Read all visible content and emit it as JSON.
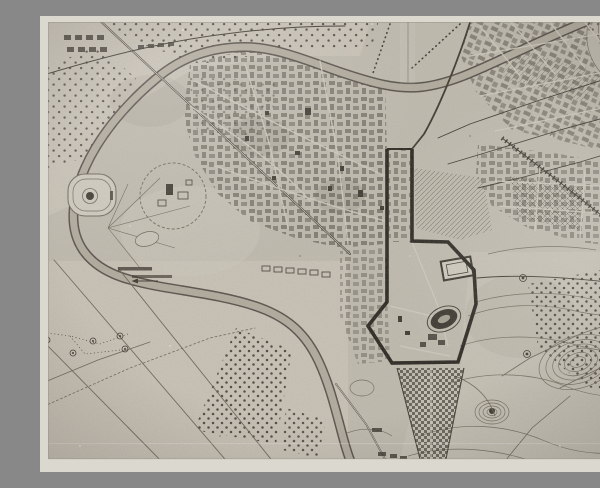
{
  "meta": {
    "title": "Black-and-white photographic print of a vintage surveyed city plan",
    "description": "Aged photo of an engraved town map: a river meanders around the old town in a large bend, a heavy dark boundary line encloses the central monumental zone with an oval amphitheatre ruin, dense hatched city blocks fill the north-east, dotted orchard parcels and contoured hills lie to the south, and a checkered ribbon suburb runs off the bottom edge.",
    "domain": "Map",
    "visible_text": ""
  },
  "theme": {
    "border": "#dbd8cf",
    "border-edge": "#948f83",
    "paper": "#c0bbae",
    "paper-light": "#cfcbbe",
    "ink-dark": "#3e3a31",
    "ink-mid": "#6e6859",
    "bold": "#2a2620",
    "water": "#b3ac9e",
    "bank": "#56514a"
  },
  "photo": {
    "border_widths": {
      "top": 6,
      "right": 11,
      "bottom": 13,
      "left": 8
    },
    "artifacts": [
      "film grain",
      "dust specks",
      "horizontal scratch line",
      "uneven exposure vignette"
    ]
  },
  "map_features": {
    "river": "wide meandering river with double embankment lines",
    "old_town": "dense irregular old-town building blocks, centre",
    "grid_city": "gridded newer quarters, upper right",
    "boundary": "heavy dark surveyed boundary around the monumental zone",
    "amphitheatre": "dark oval amphitheatre ruin inside the boundary",
    "enclosure": "large rectangular ruin enclosure inside the boundary",
    "stadium": "oval stadium ground inside the western river bend",
    "villa_hill": "round hill plateau with villa buildings, west",
    "orchards": "regularly dotted orchard and vineyard parcels",
    "hills": "contour-lined hills with plantation dots, south-east",
    "suburb": "narrow checkered ribbon suburb along the southern road",
    "railway": "hatched railway line leaving to the east",
    "wells": "small circled well symbols linked by dotted paths, south-west",
    "fields": "open surveyed fields with long straight lanes, south-west"
  }
}
